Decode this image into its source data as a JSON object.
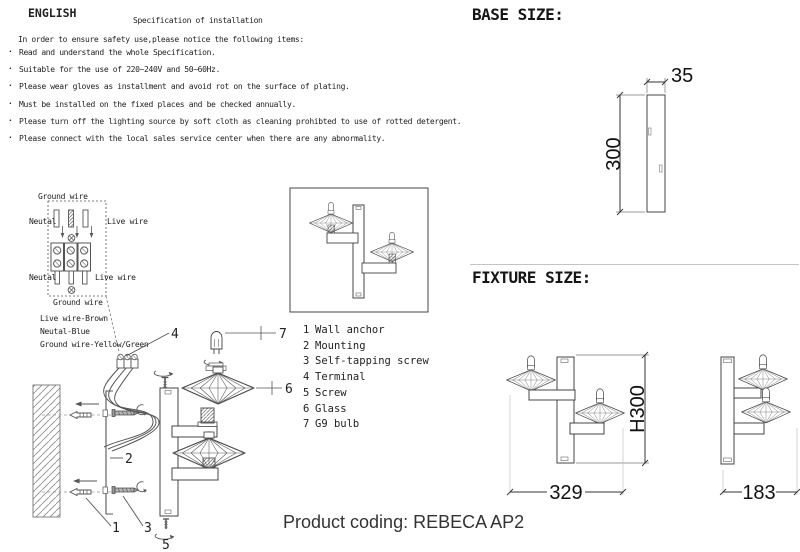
{
  "doc": {
    "language": "ENGLISH",
    "title": "Specification of installation",
    "intro": "In order to ensure safety use,please notice the following items:",
    "bullets": [
      "Read and understand the whole Specification.",
      "Suitable for the use of 220~240V and 50~60Hz.",
      "Please wear gloves as installment and avoid rot on the surface of plating.",
      "Must be installed on the fixed places and be checked annually.",
      "Please turn off the lighting source by soft cloth as cleaning prohibted to use of rotted detergent.",
      "Please connect with the local sales service center when there are any abnormality."
    ]
  },
  "wiring": {
    "ground_wire_top": "Ground wire",
    "neutral_top": "Neutal",
    "live_wire_top": "Live wire",
    "neutral_bottom": "Neutal",
    "live_wire_bottom": "Live wire",
    "ground_wire_bottom": "Ground wire",
    "legend": [
      "Live wire-Brown",
      "Neutal-Blue",
      "Ground wire-Yellow/Green"
    ]
  },
  "parts": {
    "items": [
      {
        "num": "1",
        "label": "Wall anchor"
      },
      {
        "num": "2",
        "label": "Mounting"
      },
      {
        "num": "3",
        "label": "Self-tapping screw"
      },
      {
        "num": "4",
        "label": "Terminal"
      },
      {
        "num": "5",
        "label": "Screw"
      },
      {
        "num": "6",
        "label": "Glass"
      },
      {
        "num": "7",
        "label": "G9 bulb"
      }
    ]
  },
  "callouts": {
    "c1": "1",
    "c2": "2",
    "c3": "3",
    "c4": "4",
    "c5": "5",
    "c6": "6",
    "c7": "7"
  },
  "base_size": {
    "heading": "BASE SIZE:",
    "width": "35",
    "height": "300"
  },
  "fixture_size": {
    "heading": "FIXTURE SIZE:",
    "width": "329",
    "height": "H300",
    "depth": "183"
  },
  "product": {
    "coding": "Product coding: REBECA AP2"
  }
}
